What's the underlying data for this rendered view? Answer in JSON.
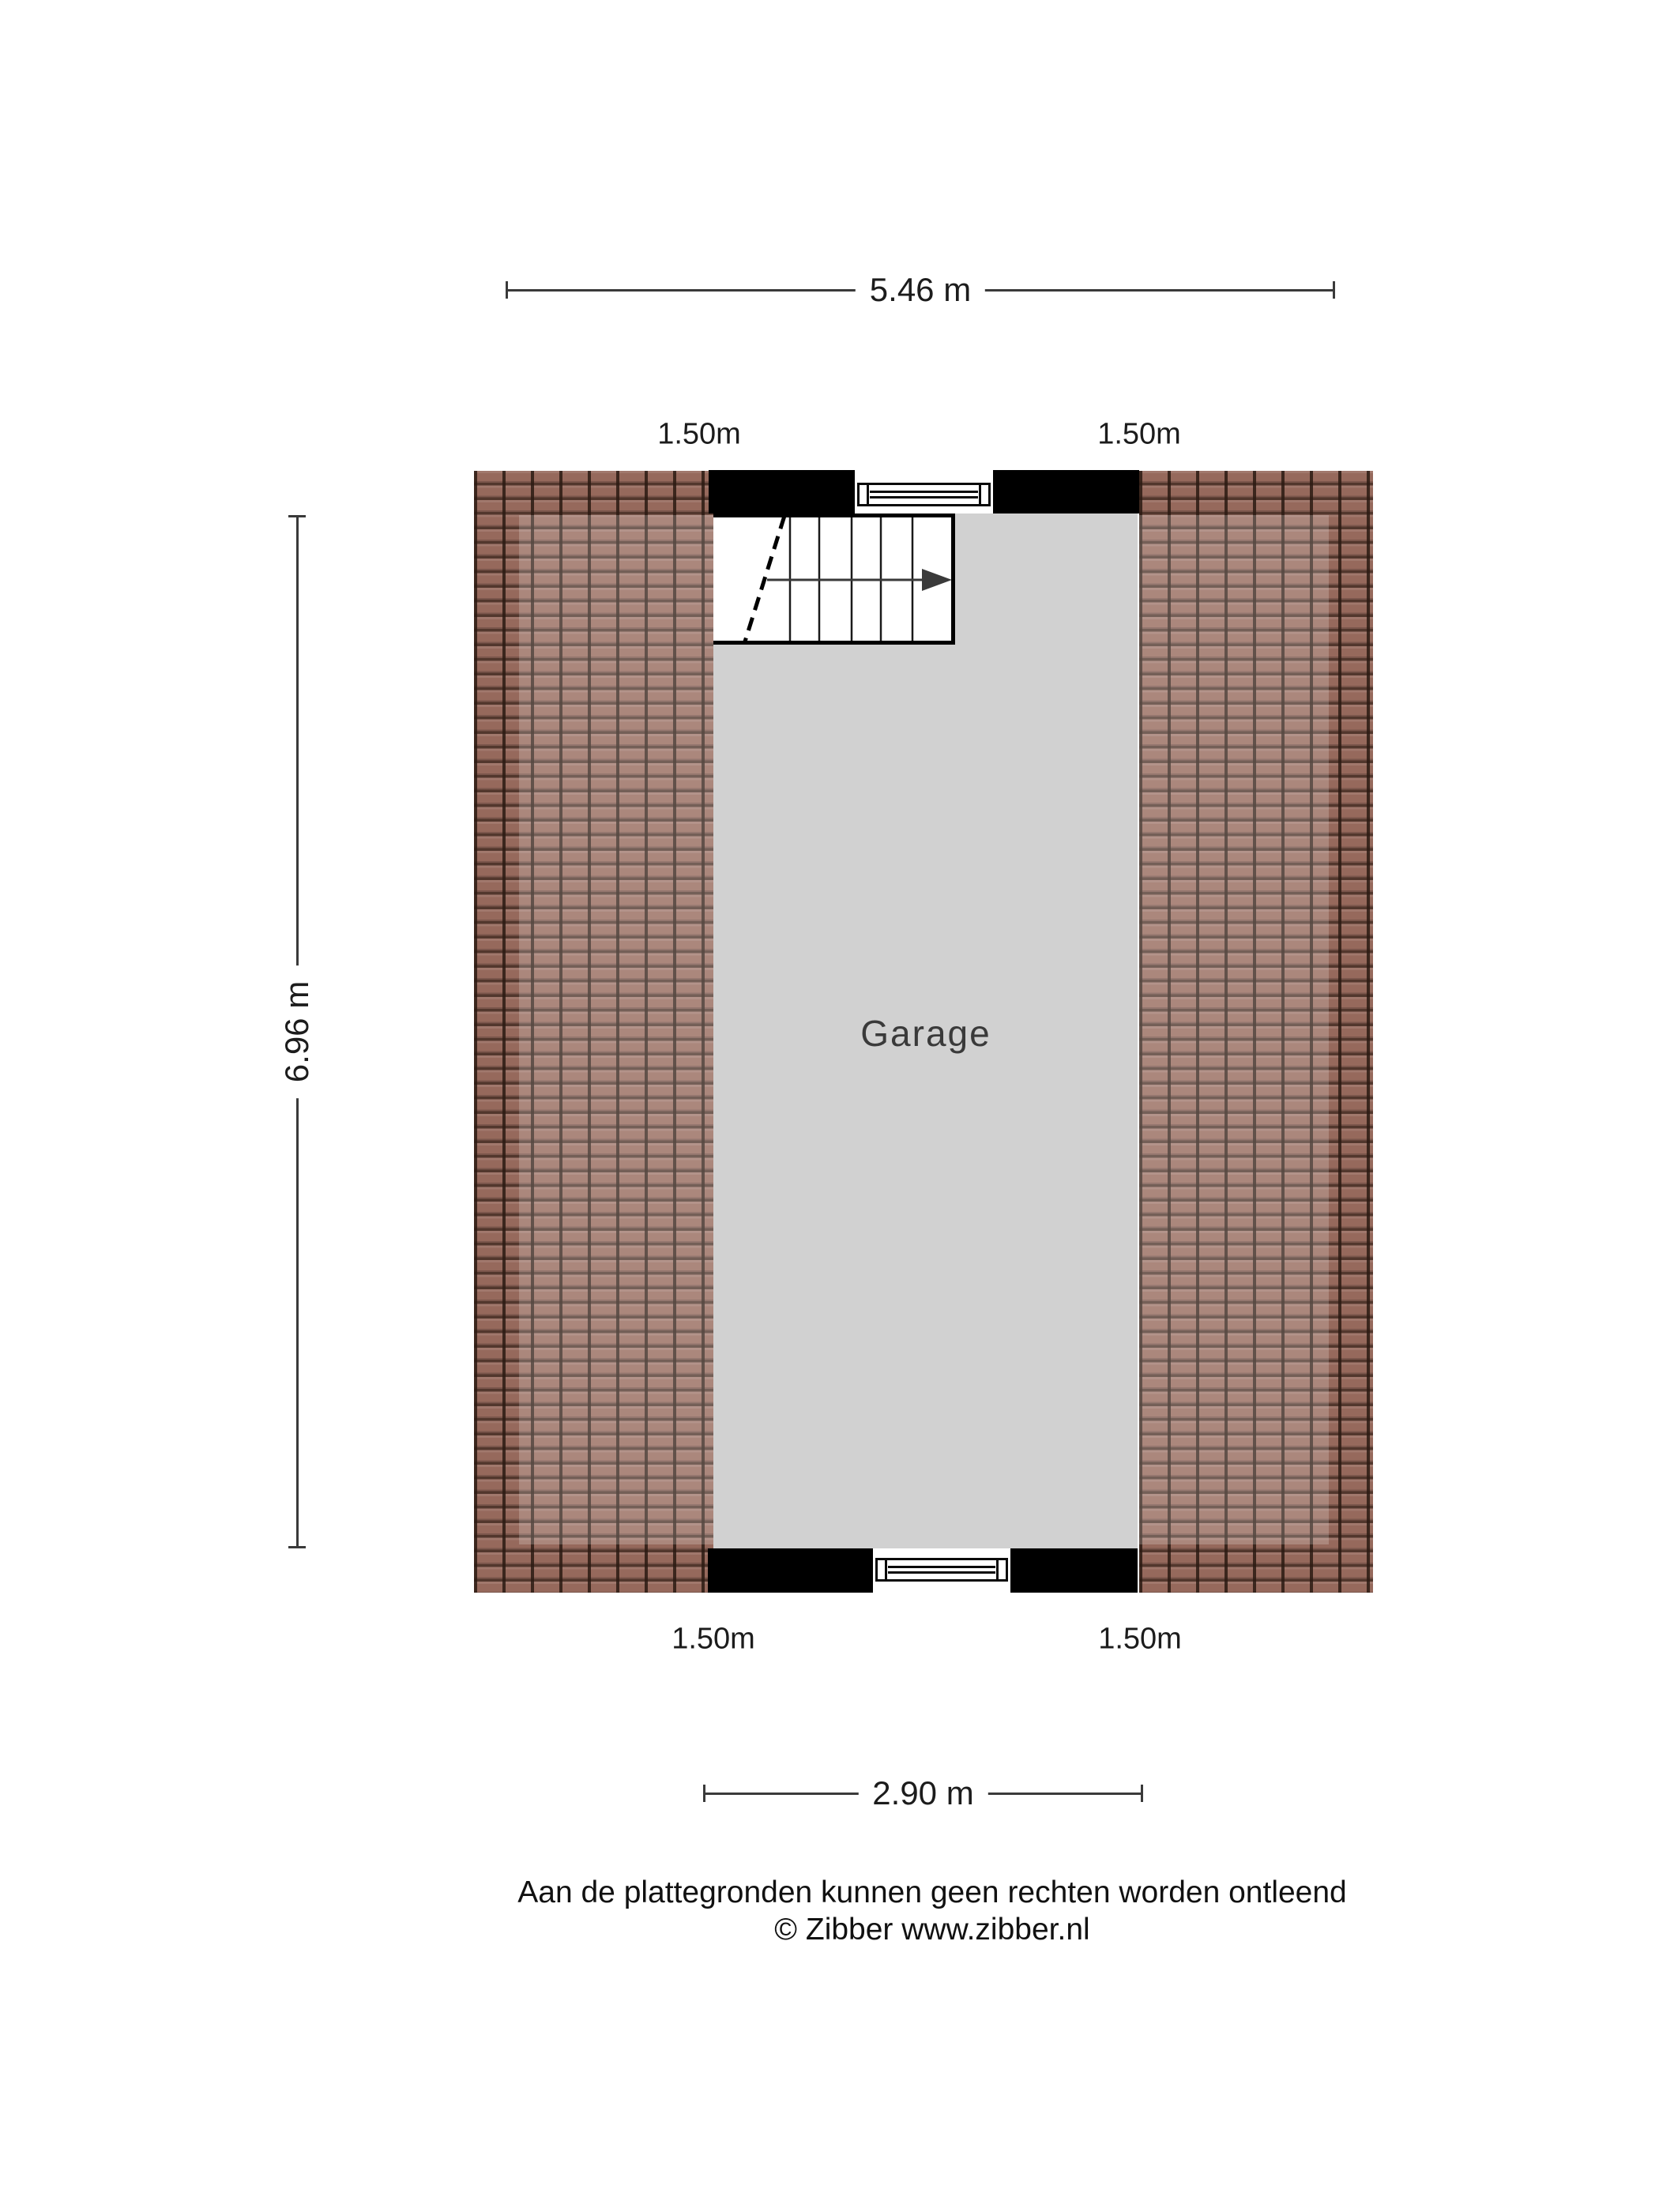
{
  "plan": {
    "room": {
      "label": "Garage"
    },
    "dimensions": {
      "total_width": "5.46 m",
      "total_depth": "6.96 m",
      "opening_width": "2.90 m",
      "roof_top_left": "1.50m",
      "roof_top_right": "1.50m",
      "roof_bottom_left": "1.50m",
      "roof_bottom_right": "1.50m"
    },
    "colors": {
      "wall": "#000000",
      "floor": "#d1d1d1",
      "roof_tile": "#96695c",
      "dimension_line": "#3a3a3a"
    }
  },
  "footer": {
    "disclaimer": "Aan de plattegronden kunnen geen rechten worden ontleend",
    "copyright": "© Zibber www.zibber.nl"
  }
}
